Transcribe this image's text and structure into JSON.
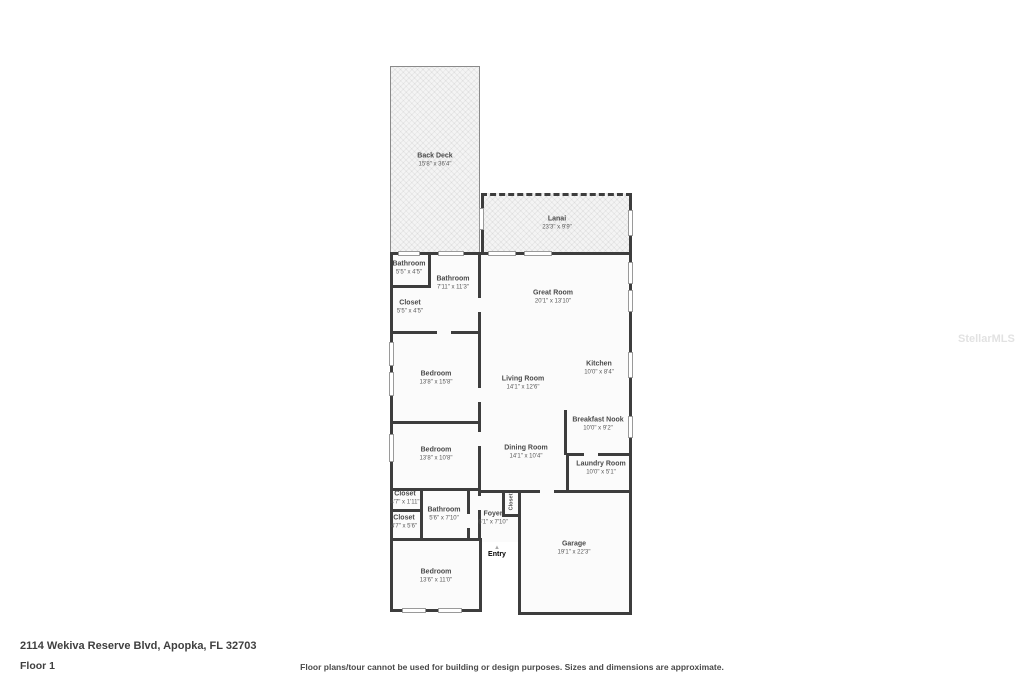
{
  "footer": {
    "address": "2114 Wekiva Reserve Blvd, Apopka, FL 32703",
    "floor_label": "Floor 1",
    "disclaimer": "Floor plans/tour cannot be used for building or design purposes. Sizes and dimensions are approximate."
  },
  "watermark": "StellarMLS",
  "icons": {
    "entry_arrow": "▲"
  },
  "colors": {
    "wall": "#3d3d3d",
    "room_fill": "#fbfbfb",
    "outdoor_fill": "#f4f4f4",
    "label_text": "#4a4a4a"
  },
  "rooms": {
    "back_deck": {
      "name": "Back Deck",
      "dims": "15'8\" x 36'4\""
    },
    "lanai": {
      "name": "Lanai",
      "dims": "23'3\" x 9'9\""
    },
    "bathroom_top": {
      "name": "Bathroom",
      "dims": "5'5\" x 4'5\""
    },
    "bathroom_main": {
      "name": "Bathroom",
      "dims": "7'11\" x 11'3\""
    },
    "closet_top": {
      "name": "Closet",
      "dims": "5'5\" x 4'5\""
    },
    "great_room": {
      "name": "Great Room",
      "dims": "20'1\" x 13'10\""
    },
    "bedroom_top": {
      "name": "Bedroom",
      "dims": "13'8\" x 15'8\""
    },
    "living_room": {
      "name": "Living Room",
      "dims": "14'1\" x 12'6\""
    },
    "kitchen": {
      "name": "Kitchen",
      "dims": "10'0\" x 8'4\""
    },
    "breakfast_nook": {
      "name": "Breakfast Nook",
      "dims": "10'0\" x 9'2\""
    },
    "bedroom_middle": {
      "name": "Bedroom",
      "dims": "13'8\" x 10'8\""
    },
    "dining_room": {
      "name": "Dining Room",
      "dims": "14'1\" x 10'4\""
    },
    "laundry_room": {
      "name": "Laundry Room",
      "dims": "10'0\" x 5'1\""
    },
    "closet_small": {
      "name": "Closet",
      "dims": "4'7\" x 1'11\""
    },
    "closet_lower": {
      "name": "Closet",
      "dims": "4'7\" x 5'6\""
    },
    "bathroom_lower": {
      "name": "Bathroom",
      "dims": "5'6\" x 7'10\""
    },
    "closet_foyer": {
      "name": "Closet"
    },
    "foyer": {
      "name": "Foyer",
      "dims": "6'1\" x 7'10\""
    },
    "entry": {
      "name": "Entry"
    },
    "garage": {
      "name": "Garage",
      "dims": "19'1\" x 22'3\""
    },
    "bedroom_bottom": {
      "name": "Bedroom",
      "dims": "13'6\" x 11'0\""
    }
  }
}
